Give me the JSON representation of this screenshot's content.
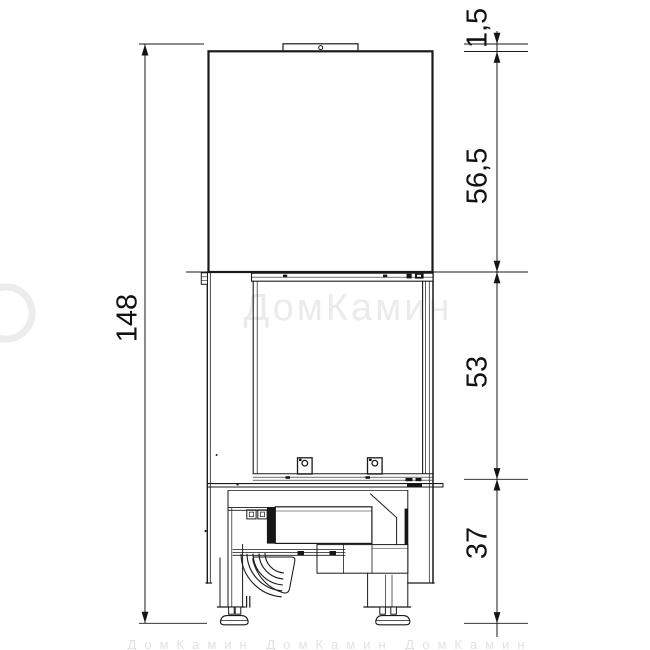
{
  "drawing_type": "fireplace-insert-front-elevation",
  "colors": {
    "background": "#ffffff",
    "line": "#1a1a1a",
    "dim_text": "#121212",
    "watermark": "#ebebeb"
  },
  "dimensions": {
    "total_height_label": "148",
    "collar_height_label": "1,5",
    "hood_height_label": "56,5",
    "firebox_height_label": "53",
    "base_height_label": "37"
  },
  "watermark": {
    "logo_text": "ДомКамин",
    "footer_text": "ДомКамин  ДомКамин  ДомКамин"
  }
}
